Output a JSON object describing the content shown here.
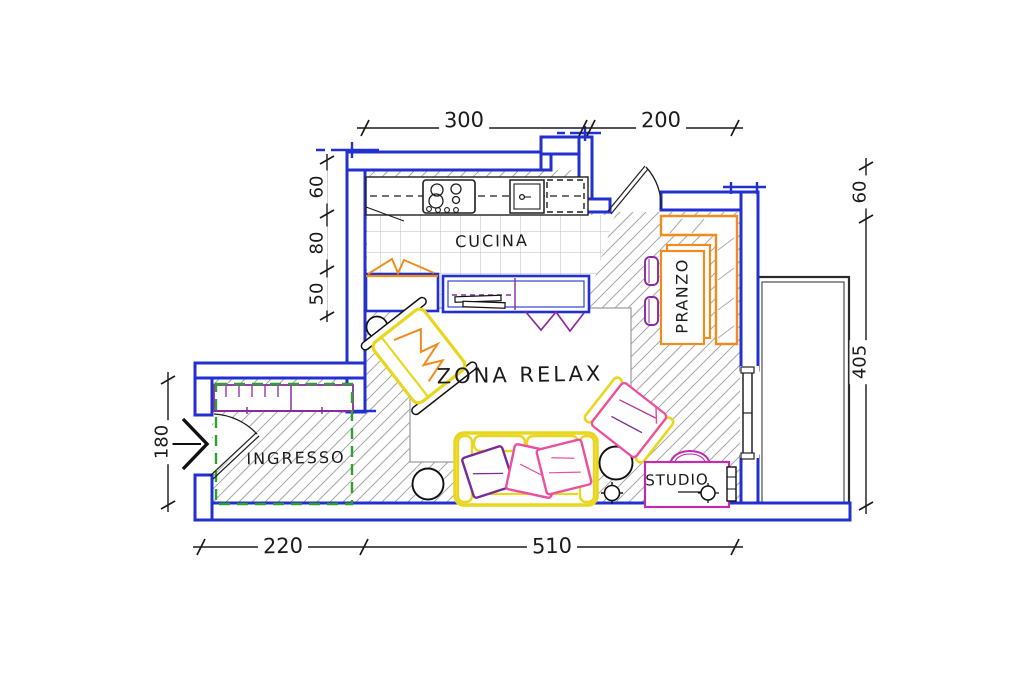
{
  "plan": {
    "title": "hand-drawn apartment floor plan",
    "rooms": {
      "kitchen": "CUCINA",
      "dining": "PRANZO",
      "relax": "ZONA RELAX",
      "entry": "INGRESSO",
      "study": "STUDIO"
    },
    "dimensions": {
      "top": [
        {
          "label": "300"
        },
        {
          "label": "200"
        }
      ],
      "left_chain": [
        {
          "label": "60"
        },
        {
          "label": "80"
        },
        {
          "label": "50"
        }
      ],
      "entry_width": {
        "label": "180"
      },
      "bottom": [
        {
          "label": "220"
        },
        {
          "label": "510"
        }
      ],
      "right_chain": [
        {
          "label": "60"
        },
        {
          "label": "405"
        }
      ]
    },
    "colors": {
      "walls": "#2230cf",
      "furniture_orange": "#f08c1e",
      "furniture_yellow": "#e8d61f",
      "accent_pink": "#ec4f9e",
      "accent_purple": "#7b2a96",
      "desk_magenta": "#c02cb0",
      "area_green": "#2ea02e",
      "sketch_black": "#1e1e1e",
      "hatch_gray": "#a8a8a8"
    }
  }
}
